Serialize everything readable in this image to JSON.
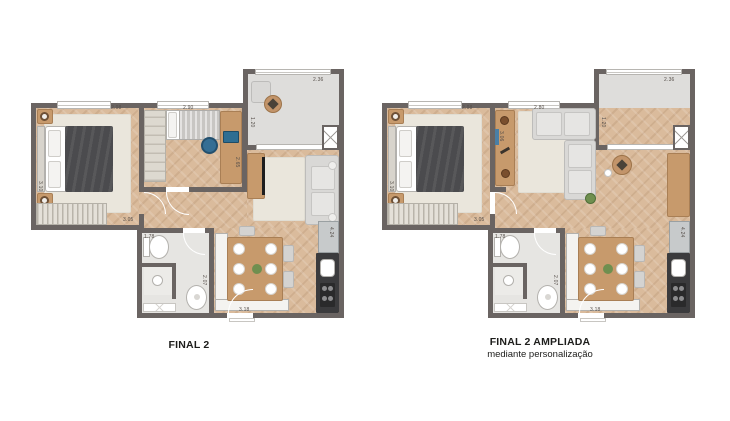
{
  "captions": {
    "note": "two apartment floor plan variants shown side by side"
  },
  "plans": [
    {
      "id": "final-2",
      "title": "FINAL 2",
      "dimensions": {
        "bedroom1_width": "2.98",
        "bedroom1_depth": "3.10",
        "bedroom2_width": "2.90",
        "bedroom2_depth": "2.65",
        "balcony_width": "2.36",
        "balcony_depth": "1.20",
        "hall_length": "3.05",
        "bathroom_width": "1.78",
        "bathroom_depth": "2.07",
        "kitchen_width": "3.18",
        "kitchen_depth": "4.24"
      }
    },
    {
      "id": "final-2-ampliada",
      "title": "FINAL 2 AMPLIADA",
      "subtitle": "mediante personalização",
      "dimensions": {
        "bedroom1_width": "2.98",
        "bedroom1_depth": "3.10",
        "living_width": "2.80",
        "living_depth": "3.06",
        "balcony_width": "2.36",
        "balcony_depth": "1.20",
        "hall_length": "3.05",
        "bathroom_width": "1.78",
        "bathroom_depth": "2.07",
        "kitchen_width": "3.18",
        "kitchen_depth": "4.24"
      }
    }
  ],
  "colors": {
    "wall": "#6a6462",
    "wood_floor": "#dabb9c",
    "balcony_floor": "#dedddb",
    "bathroom_floor": "#e6e5e2",
    "rug": "#eae6dc",
    "furniture_wood": "#c79a6c",
    "sofa": "#d9d8d6",
    "duvet": "#4b4b4e",
    "kitchen_counter": "#3b3b3d",
    "stainless": "#c7cacb",
    "title_text": "#1d1d1b",
    "dimension_text": "#564f4a",
    "background": "#ffffff"
  }
}
